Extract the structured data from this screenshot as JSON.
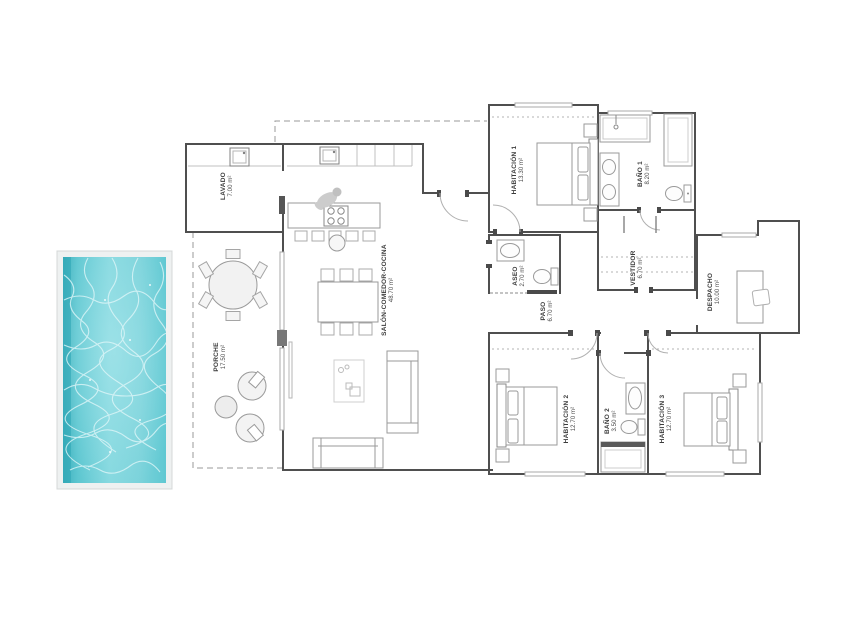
{
  "plan": {
    "type": "floor-plan",
    "rooms": [
      {
        "id": "lavado",
        "name": "LAVADO",
        "area": "7.00 m²"
      },
      {
        "id": "porche",
        "name": "PORCHE",
        "area": "17.50 m²"
      },
      {
        "id": "salon",
        "name": "SALÓN-COMEDOR-COCINA",
        "area": "48.70 m²"
      },
      {
        "id": "hab1",
        "name": "HABITACIÓN 1",
        "area": "13.30 m²"
      },
      {
        "id": "bano1",
        "name": "BAÑO 1",
        "area": "8.20 m²"
      },
      {
        "id": "vestidor",
        "name": "VESTIDOR",
        "area": "6.70 m²"
      },
      {
        "id": "aseo",
        "name": "ASEO",
        "area": "2.70 m²"
      },
      {
        "id": "paso",
        "name": "PASO",
        "area": "6.70 m²"
      },
      {
        "id": "despacho",
        "name": "DESPACHO",
        "area": "10.00 m²"
      },
      {
        "id": "hab2",
        "name": "HABITACIÓN 2",
        "area": "12.70 m²"
      },
      {
        "id": "bano2",
        "name": "BAÑO 2",
        "area": "3.50 m²"
      },
      {
        "id": "hab3",
        "name": "HABITACIÓN 3",
        "area": "12.70 m²"
      }
    ],
    "colors": {
      "wall": "#4f4f4f",
      "furniture_line": "#9a9a9a",
      "pool_water": "#6fcfd8",
      "pool_water_edge": "#3fb0bd",
      "pool_caustics": "#dff6f8"
    }
  }
}
